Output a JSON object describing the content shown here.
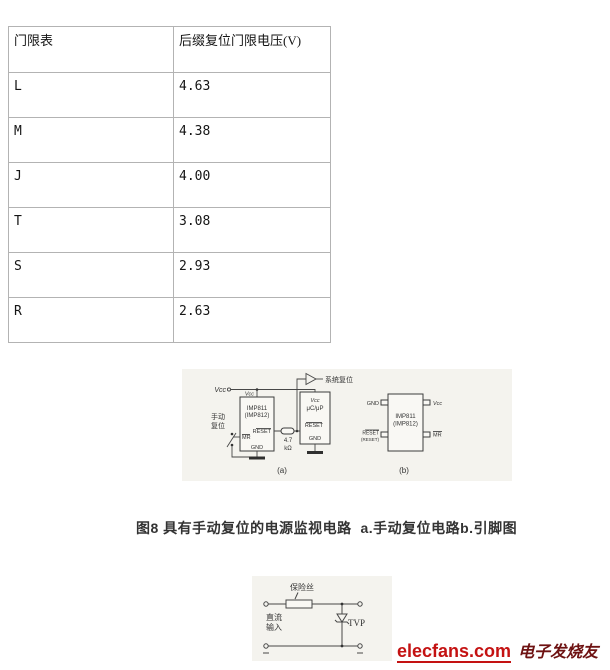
{
  "table": {
    "header": [
      "门限表",
      "后缀复位门限电压(V)"
    ],
    "rows": [
      {
        "label": "L",
        "value": "4.63"
      },
      {
        "label": "M",
        "value": "4.38"
      },
      {
        "label": "J",
        "value": "4.00"
      },
      {
        "label": "T",
        "value": "3.08"
      },
      {
        "label": "S",
        "value": "2.93"
      },
      {
        "label": "R",
        "value": "2.63"
      }
    ]
  },
  "figure8": {
    "caption": "图8 具有手动复位的电源监视电路  a.手动复位电路b.引脚图",
    "circuit_a": {
      "tag": "(a)",
      "vcc_label": "Vcc",
      "chip_vcc_pin": "Vcc",
      "chip_name": "IMP811",
      "chip_name_alt": "(IMP812)",
      "pin_reset": "RESET",
      "pin_mr": "MR",
      "pin_gnd": "GND",
      "manual_reset_line1": "手动",
      "manual_reset_line2": "复位",
      "resistor_value": "4.7",
      "resistor_unit": "kΩ",
      "mcu_vcc": "Vcc",
      "mcu_name": "μC/μP",
      "mcu_reset": "RESET",
      "mcu_gnd": "GND",
      "system_reset_label": "系统复位"
    },
    "circuit_b": {
      "tag": "(b)",
      "chip_name": "IMP811",
      "chip_name_alt": "(IMP812)",
      "pin_gnd": "GND",
      "pin_vcc": "Vcc",
      "pin_reset": "RESET",
      "pin_reset_alt": "(RESET)",
      "pin_mr": "MR"
    }
  },
  "figure9": {
    "fuse_label": "保险丝",
    "dc_input_line1": "直流",
    "dc_input_line2": "输入",
    "tvs_label": "TVP"
  },
  "watermark": {
    "site": "elecfans.com",
    "site_cn": "电子发烧友",
    "brand_red": "#c41212",
    "brand_dark": "#6e1212"
  }
}
